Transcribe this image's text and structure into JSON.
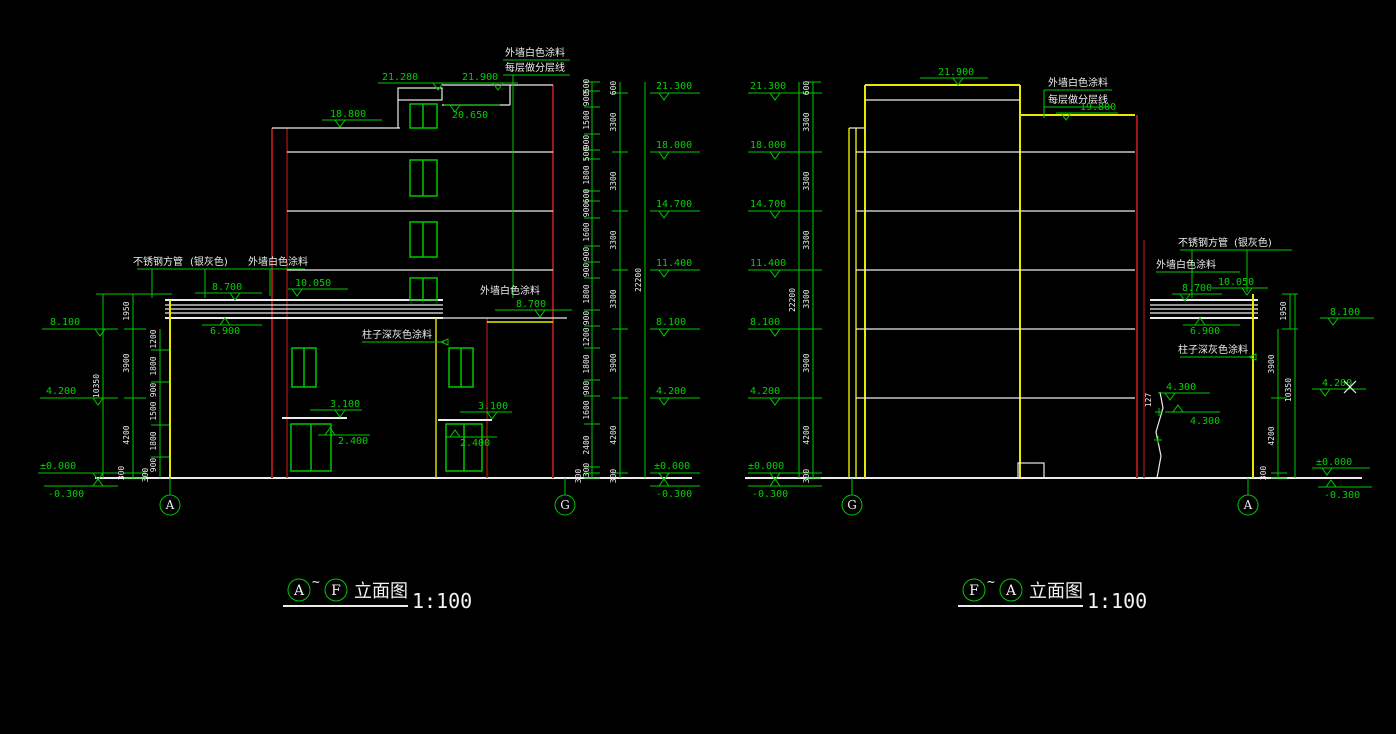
{
  "colors": {
    "bg": "#000000",
    "green": "#00c800",
    "white": "#ececec",
    "red": "#a01616",
    "yellow": "#e8e800"
  },
  "left_view": {
    "ann_top_line1": "外墙白色涂料",
    "ann_top_line2": "每层做分层线",
    "e21900": "21.900",
    "e21280": "21.280",
    "e20650": "20.650",
    "e18800": "18.800",
    "ann_steel": "不锈钢方管",
    "ann_silver": "(银灰色)",
    "ann_paint_left": "外墙白色涂料",
    "e8700_left": "8.700",
    "e10050": "10.050",
    "e6900": "6.900",
    "ann_column": "柱子深灰色涂料",
    "ann_paint_right": "外墙白色涂料",
    "e8700_right": "8.700",
    "e3100_left": "3.100",
    "e2400_left": "2.400",
    "e3100_right": "3.100",
    "e2400_right": "2.400",
    "left_col": {
      "levels": [
        "8.100",
        "4.200",
        "±0.000",
        "-0.300"
      ],
      "outer_dims": [
        "1950",
        "3900",
        "4200",
        "300"
      ],
      "inner_dims": [
        "1200",
        "1800",
        "900",
        "1500",
        "1800",
        "900"
      ],
      "base_dim": "300",
      "total": "10350"
    },
    "right_col": {
      "levels": [
        "21.300",
        "18.000",
        "14.700",
        "11.400",
        "8.100",
        "4.200",
        "±0.000",
        "-0.300"
      ],
      "small_dims": [
        "500",
        "900",
        "1500",
        "900",
        "500",
        "1800",
        "600",
        "900",
        "1600",
        "900",
        "900",
        "1800",
        "900",
        "1200",
        "1800",
        "900",
        "1600",
        "2400",
        "300",
        "300"
      ],
      "mid_dims": [
        "600",
        "3300",
        "3300",
        "3300",
        "3300",
        "3900",
        "4200",
        "300"
      ],
      "total": "22200"
    },
    "grid_left": "A",
    "grid_right": "G",
    "title": {
      "bubble1": "A",
      "sep": "~",
      "bubble2": "F",
      "name": "立面图",
      "scale": "1:100"
    }
  },
  "right_view": {
    "e21900": "21.900",
    "ann_top_line1": "外墙白色涂料",
    "ann_top_line2": "每层做分层线",
    "e19800": "19.800",
    "left_col": {
      "levels": [
        "21.300",
        "18.000",
        "14.700",
        "11.400",
        "8.100",
        "4.200",
        "±0.000",
        "-0.300"
      ],
      "mid_dims": [
        "600",
        "3300",
        "3300",
        "3300",
        "3300",
        "3900",
        "4200",
        "300"
      ],
      "total": "22200"
    },
    "ann_steel": "不锈钢方管",
    "ann_silver": "(银灰色)",
    "ann_paint": "外墙白色涂料",
    "e8700": "8.700",
    "e10050": "10.050",
    "e6900": "6.900",
    "dim_1950": "1950",
    "e8100": "8.100",
    "ann_column": "柱子深灰色涂料",
    "e4300_upper": "4.300",
    "e4300_lower": "4.300",
    "dim_127": "127",
    "dim_3900": "3900",
    "dim_10350": "10350",
    "dim_4200": "4200",
    "dim_300": "300",
    "e4200": "4.200",
    "e0000": "±0.000",
    "em0300": "-0.300",
    "grid_left": "G",
    "grid_right": "A",
    "title": {
      "bubble1": "F",
      "sep": "~",
      "bubble2": "A",
      "name": "立面图",
      "scale": "1:100"
    }
  }
}
